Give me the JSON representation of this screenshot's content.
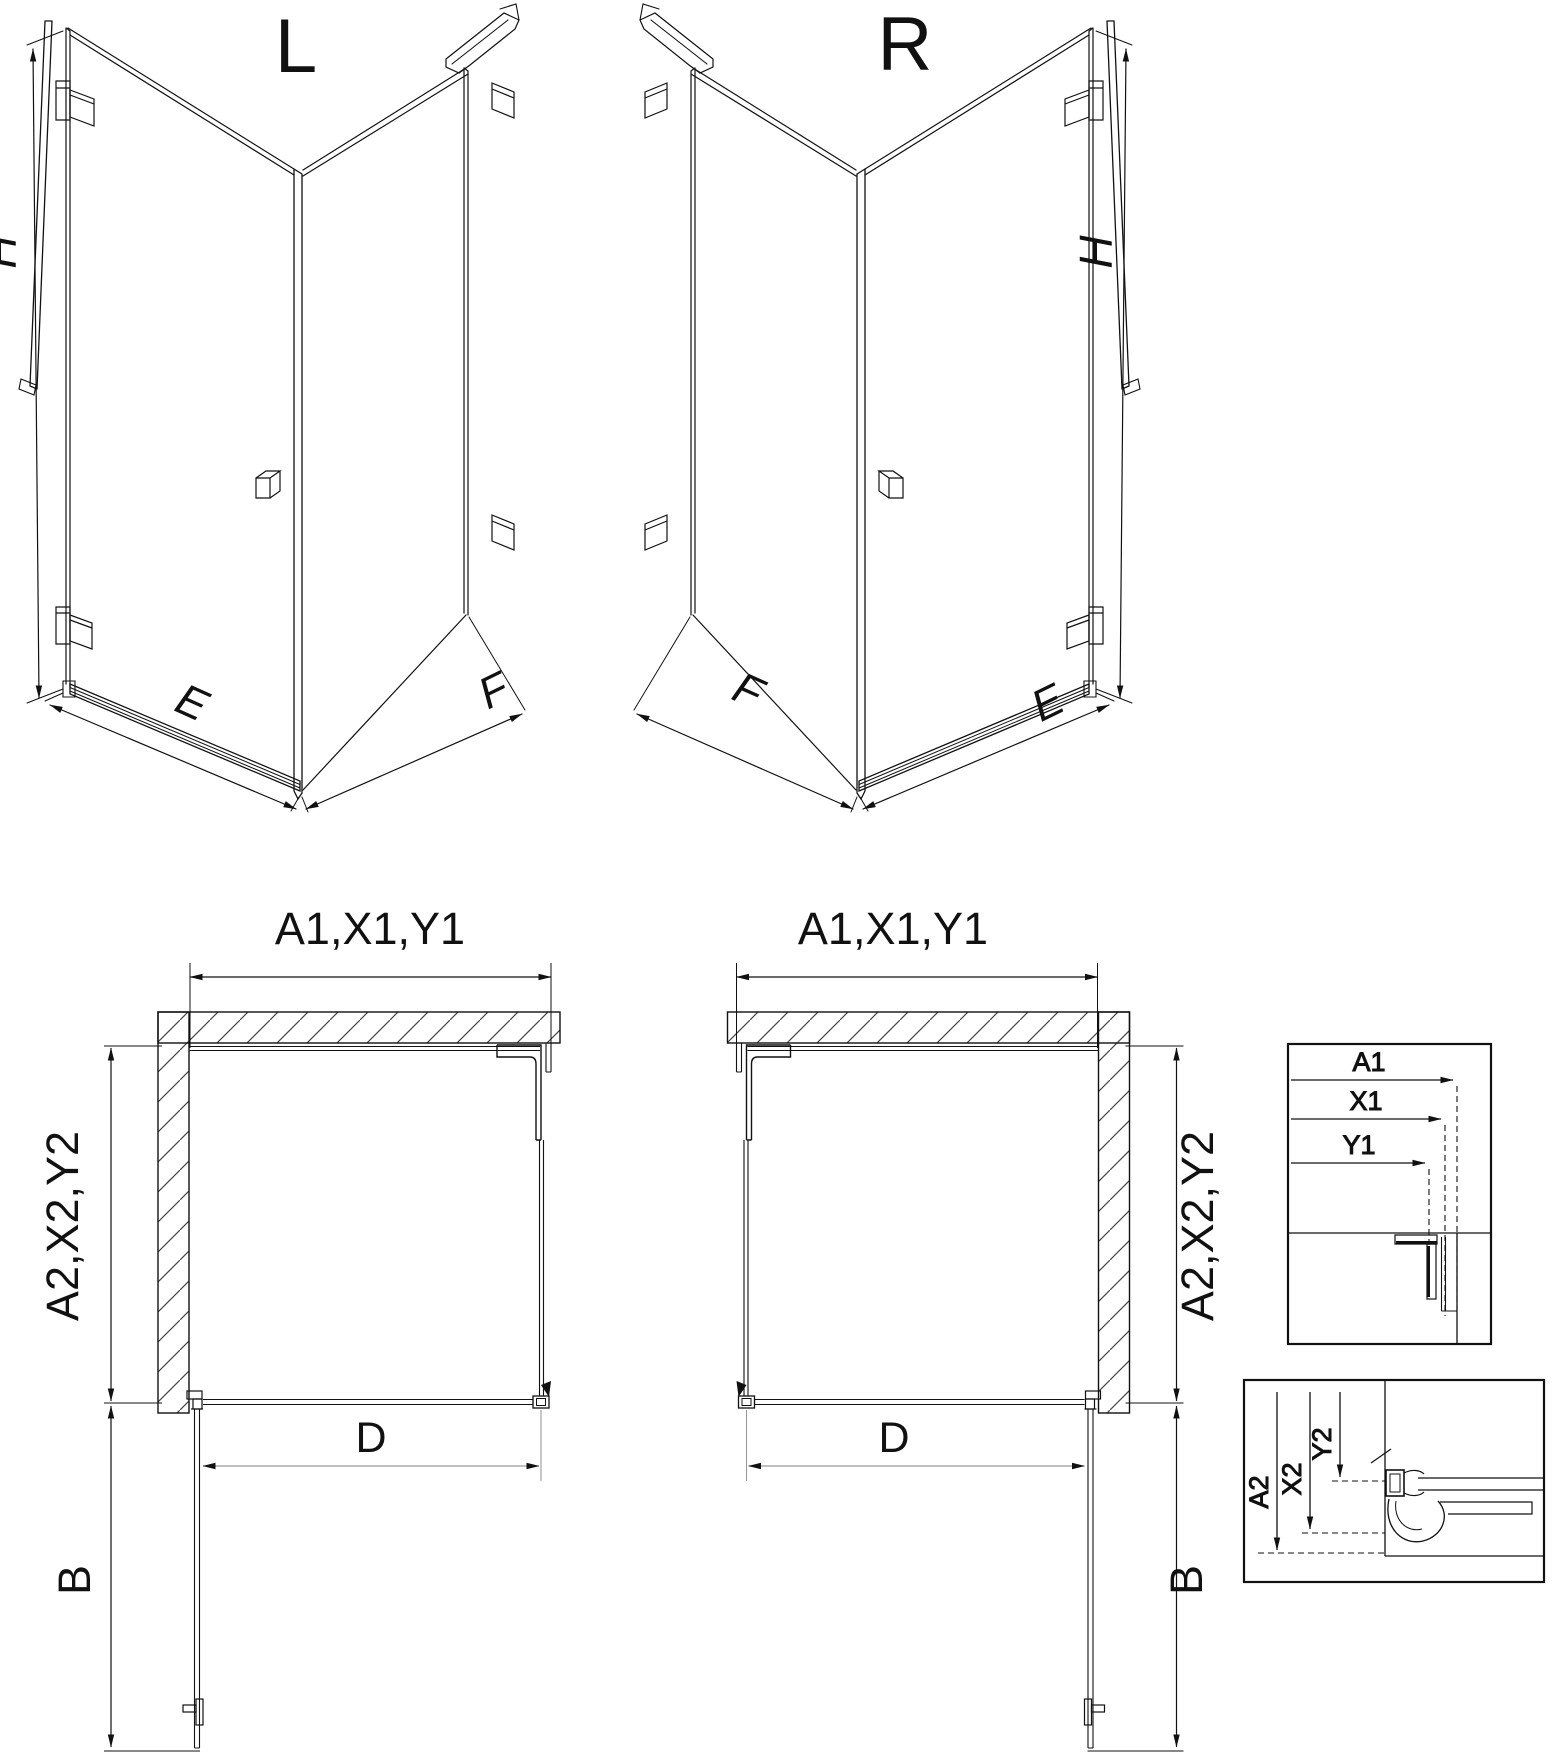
{
  "figure": {
    "type": "shower-enclosure-technical-drawing",
    "background": "#ffffff",
    "line_color": "#111111",
    "aux_line_color": "#9b9b9b",
    "hatch_color": "#444444"
  },
  "iso_views": {
    "left": {
      "title": "L",
      "height_label": "H",
      "door_side_label": "E",
      "fixed_side_label": "F"
    },
    "right": {
      "title": "R",
      "height_label": "H",
      "door_side_label": "E",
      "fixed_side_label": "F"
    }
  },
  "plan_views": {
    "left": {
      "top_dim": "A1,X1,Y1",
      "side_dim": "A2,X2,Y2",
      "door_width_dim": "D",
      "door_swing_dim": "B"
    },
    "right": {
      "top_dim": "A1,X1,Y1",
      "side_dim": "A2,X2,Y2",
      "door_width_dim": "D",
      "door_swing_dim": "B"
    }
  },
  "detail_views": {
    "width_reference": {
      "labels": [
        "A1",
        "X1",
        "Y1"
      ]
    },
    "depth_reference": {
      "labels": [
        "A2",
        "X2",
        "Y2"
      ]
    }
  }
}
